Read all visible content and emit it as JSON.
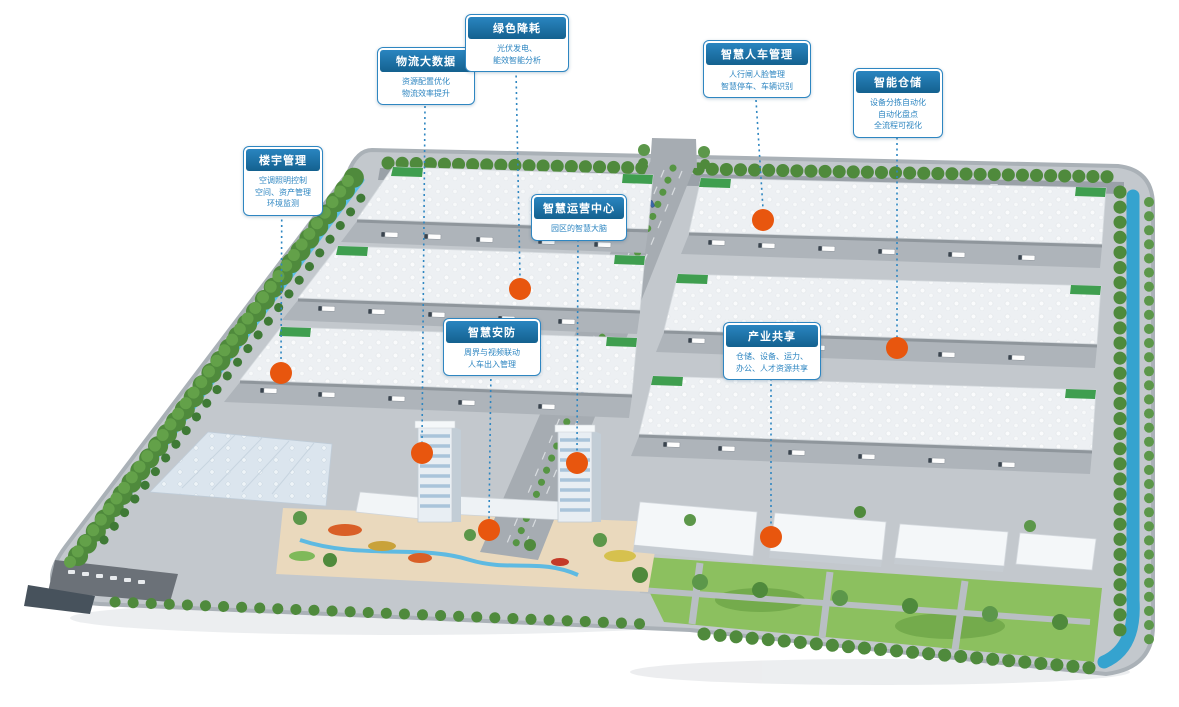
{
  "figure": {
    "kind": "smart-logistics-park-aerial-rendering",
    "marker_count": 8
  },
  "colors": {
    "callout_border": "#2e86c1",
    "callout_title_bg": "#14618f",
    "callout_text": "#2e86c1",
    "marker_orange": "#e8560e",
    "canal_blue": "#35a3cf",
    "lawn_green": "#8cc05f",
    "tree_green": "#4f8a3c",
    "road_gray": "#a6acb2",
    "roof_white": "#eef1f4"
  },
  "callouts": [
    {
      "id": "building-management",
      "title": "楼宇管理",
      "lines": [
        "空调照明控制",
        "空间、资产管理",
        "环境监测"
      ]
    },
    {
      "id": "logistics-bigdata",
      "title": "物流大数据",
      "lines": [
        "资源配置优化",
        "物流效率提升"
      ]
    },
    {
      "id": "green-energy",
      "title": "绿色降耗",
      "lines": [
        "光伏发电、",
        "能效智能分析"
      ]
    },
    {
      "id": "operations-center",
      "title": "智慧运营中心",
      "lines": [
        "园区的智慧大脑"
      ]
    },
    {
      "id": "people-vehicle-management",
      "title": "智慧人车管理",
      "lines": [
        "人行闸人脸管理",
        "智慧停车、车辆识别"
      ]
    },
    {
      "id": "smart-warehouse",
      "title": "智能仓储",
      "lines": [
        "设备分拣自动化",
        "自动化盘点",
        "全流程可视化"
      ]
    },
    {
      "id": "smart-security",
      "title": "智慧安防",
      "lines": [
        "周界与视频联动",
        "人车出入管理"
      ]
    },
    {
      "id": "industry-sharing",
      "title": "产业共享",
      "lines": [
        "仓储、设备、运力、",
        "办公、人才资源共享"
      ]
    }
  ]
}
